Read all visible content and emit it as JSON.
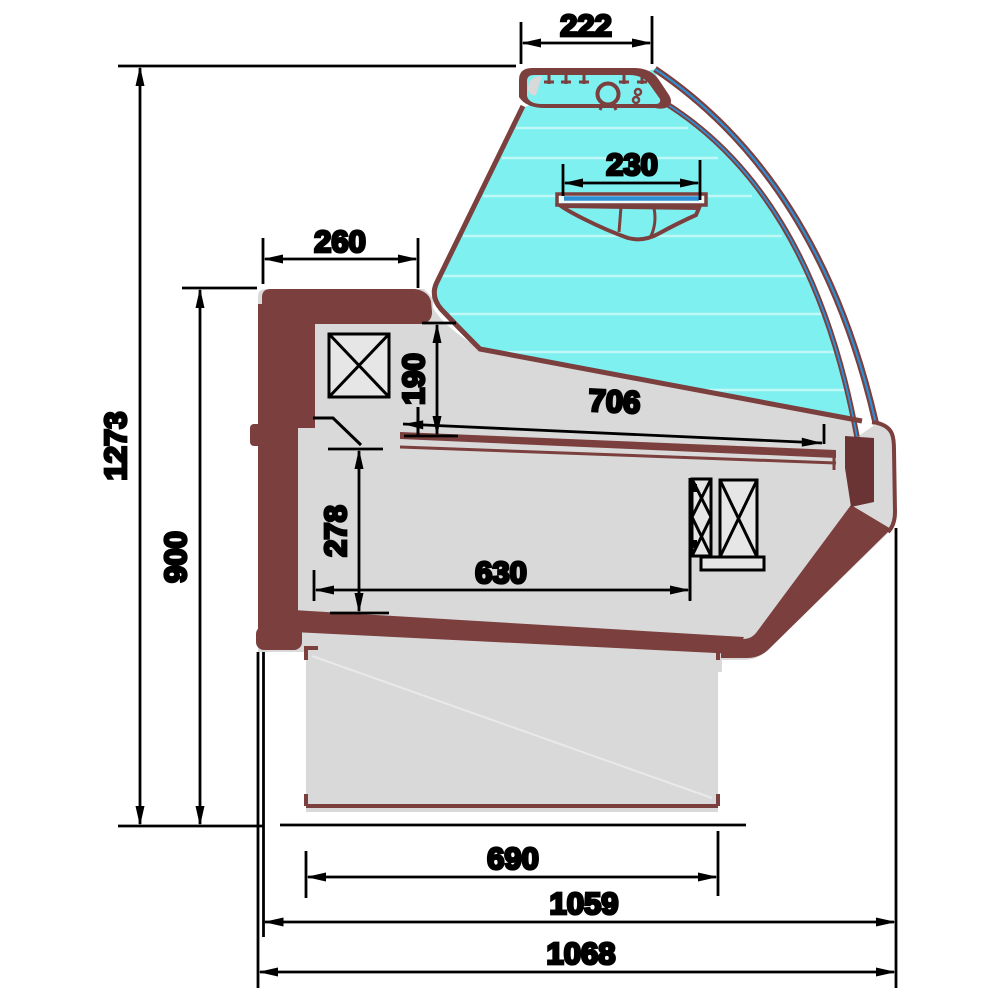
{
  "dimensions": {
    "top_canopy_width": "222",
    "shelf_width": "230",
    "worktop_depth": "260",
    "rear_opening_height": "190",
    "display_surface_depth": "706",
    "well_inner_height": "278",
    "well_inner_depth": "630",
    "overall_height": "1273",
    "worktop_height": "900",
    "base_depth": "690",
    "body_depth": "1059",
    "overall_depth": "1068"
  },
  "colors": {
    "frame_maroon": "#7b3f3e",
    "frame_dark": "#6a3434",
    "panel_gray": "#d9d9d9",
    "glass_cyan": "#7ef0ef",
    "glass_blue": "#2d8fd5",
    "line_black": "#000000",
    "background": "#ffffff"
  }
}
